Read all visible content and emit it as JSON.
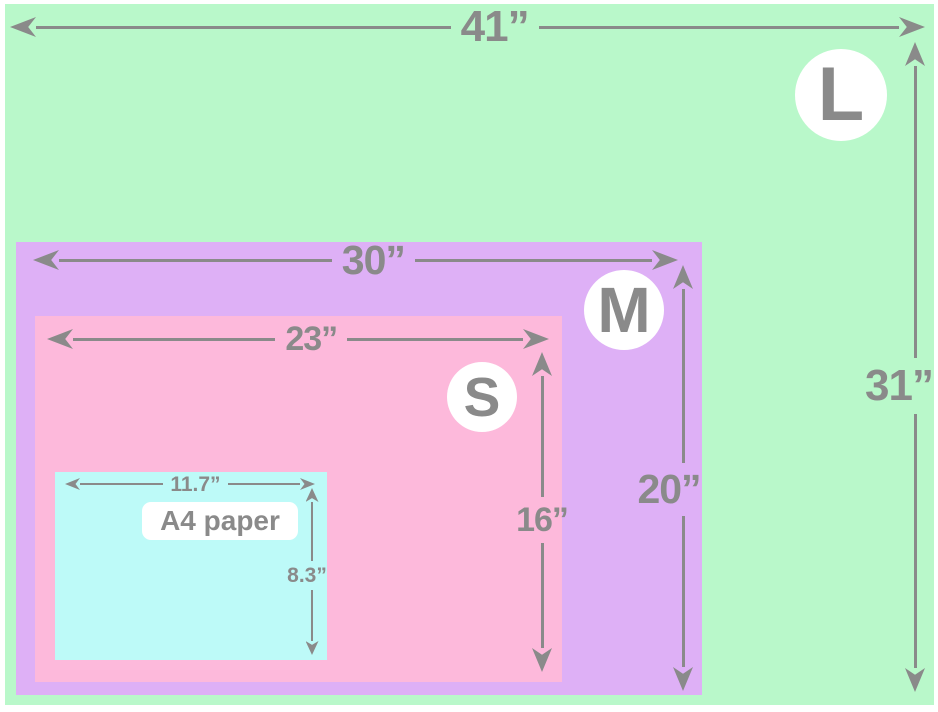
{
  "colors": {
    "canvas-bg": "#ffffff",
    "size-l": "#b9f8ca",
    "size-m": "#deb0f6",
    "size-s": "#fdb9db",
    "size-a4": "#bdfaf8",
    "dimension-gray": "#8a8a8a",
    "badge-bg": "#ffffff"
  },
  "diagram": {
    "l": {
      "letter": "L",
      "width": "41”",
      "height": "31”"
    },
    "m": {
      "letter": "M",
      "width": "30”",
      "height": "20”"
    },
    "s": {
      "letter": "S",
      "width": "23”",
      "height": "16”"
    },
    "a4": {
      "label": "A4 paper",
      "width": "11.7”",
      "height": "8.3”"
    }
  }
}
